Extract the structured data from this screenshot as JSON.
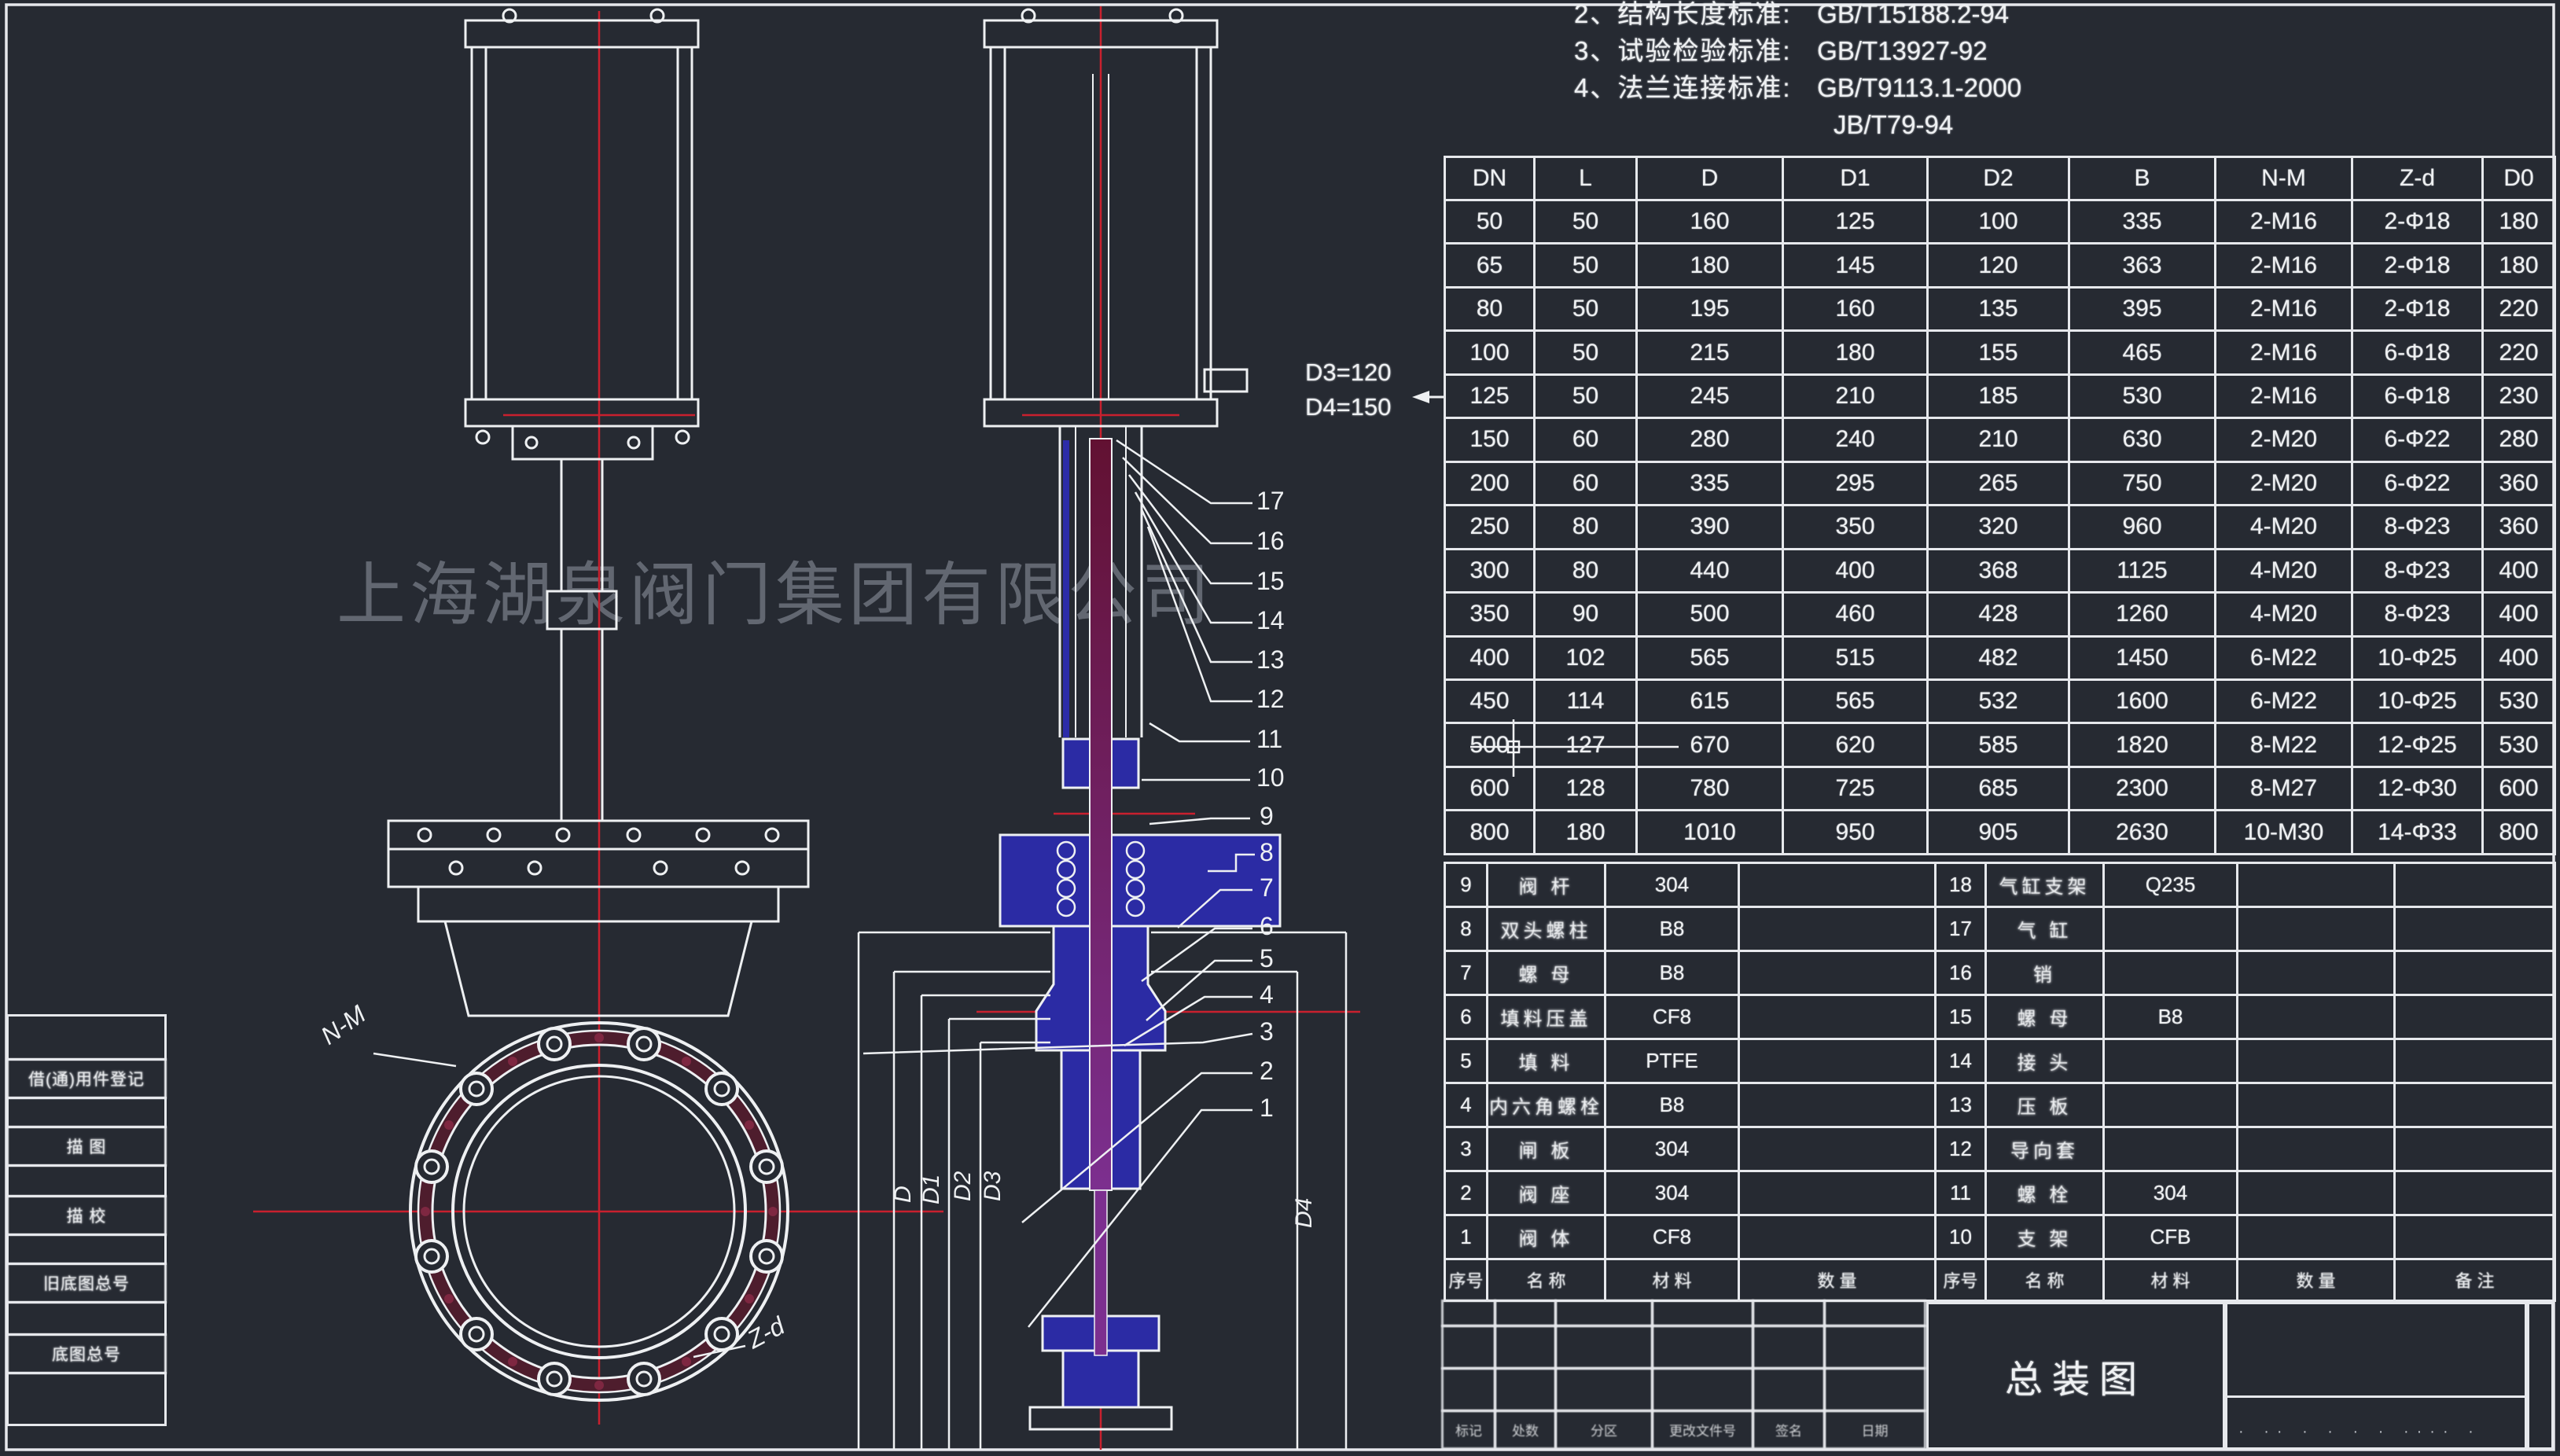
{
  "watermark": "上海湖泉阀门集团有限公司",
  "standards": {
    "lines": [
      {
        "label": "2、结构长度标准:",
        "value": "GB/T15188.2-94"
      },
      {
        "label": "3、试验检验标准:",
        "value": "GB/T13927-92"
      },
      {
        "label": "4、法兰连接标准:",
        "value": "GB/T9113.1-2000"
      },
      {
        "label": "",
        "value": "JB/T79-94"
      }
    ]
  },
  "annotation": {
    "d3": "D3=120",
    "d4": "D4=150"
  },
  "dim_table": {
    "headers": [
      "DN",
      "L",
      "D",
      "D1",
      "D2",
      "B",
      "N-M",
      "Z-d",
      "D0"
    ],
    "rows": [
      [
        "50",
        "50",
        "160",
        "125",
        "100",
        "335",
        "2-M16",
        "2-Φ18",
        "180"
      ],
      [
        "65",
        "50",
        "180",
        "145",
        "120",
        "363",
        "2-M16",
        "2-Φ18",
        "180"
      ],
      [
        "80",
        "50",
        "195",
        "160",
        "135",
        "395",
        "2-M16",
        "2-Φ18",
        "220"
      ],
      [
        "100",
        "50",
        "215",
        "180",
        "155",
        "465",
        "2-M16",
        "6-Φ18",
        "220"
      ],
      [
        "125",
        "50",
        "245",
        "210",
        "185",
        "530",
        "2-M16",
        "6-Φ18",
        "230"
      ],
      [
        "150",
        "60",
        "280",
        "240",
        "210",
        "630",
        "2-M20",
        "6-Φ22",
        "280"
      ],
      [
        "200",
        "60",
        "335",
        "295",
        "265",
        "750",
        "2-M20",
        "6-Φ22",
        "360"
      ],
      [
        "250",
        "80",
        "390",
        "350",
        "320",
        "960",
        "4-M20",
        "8-Φ23",
        "360"
      ],
      [
        "300",
        "80",
        "440",
        "400",
        "368",
        "1125",
        "4-M20",
        "8-Φ23",
        "400"
      ],
      [
        "350",
        "90",
        "500",
        "460",
        "428",
        "1260",
        "4-M20",
        "8-Φ23",
        "400"
      ],
      [
        "400",
        "102",
        "565",
        "515",
        "482",
        "1450",
        "6-M22",
        "10-Φ25",
        "400"
      ],
      [
        "450",
        "114",
        "615",
        "565",
        "532",
        "1600",
        "6-M22",
        "10-Φ25",
        "530"
      ],
      [
        "500",
        "127",
        "670",
        "620",
        "585",
        "1820",
        "8-M22",
        "12-Φ25",
        "530"
      ],
      [
        "600",
        "128",
        "780",
        "725",
        "685",
        "2300",
        "8-M27",
        "12-Φ30",
        "600"
      ],
      [
        "800",
        "180",
        "1010",
        "950",
        "905",
        "2630",
        "10-M30",
        "14-Φ33",
        "800"
      ]
    ]
  },
  "bom_left": {
    "rows": [
      [
        "9",
        "阀 杆",
        "304",
        ""
      ],
      [
        "8",
        "双头螺柱",
        "B8",
        ""
      ],
      [
        "7",
        "螺 母",
        "B8",
        ""
      ],
      [
        "6",
        "填料压盖",
        "CF8",
        ""
      ],
      [
        "5",
        "填 料",
        "PTFE",
        ""
      ],
      [
        "4",
        "内六角螺栓",
        "B8",
        ""
      ],
      [
        "3",
        "闸 板",
        "304",
        ""
      ],
      [
        "2",
        "阀 座",
        "304",
        ""
      ],
      [
        "1",
        "阀 体",
        "CF8",
        ""
      ]
    ]
  },
  "bom_right": {
    "rows": [
      [
        "18",
        "气缸支架",
        "Q235",
        "",
        ""
      ],
      [
        "17",
        "气 缸",
        "",
        "",
        ""
      ],
      [
        "16",
        "销",
        "",
        "",
        ""
      ],
      [
        "15",
        "螺 母",
        "B8",
        "",
        ""
      ],
      [
        "14",
        "接 头",
        "",
        "",
        ""
      ],
      [
        "13",
        "压 板",
        "",
        "",
        ""
      ],
      [
        "12",
        "导向套",
        "",
        "",
        ""
      ],
      [
        "11",
        "螺 栓",
        "304",
        "",
        ""
      ],
      [
        "10",
        "支 架",
        "CFB",
        "",
        ""
      ]
    ]
  },
  "bom_header": [
    "序号",
    "名 称",
    "材 料",
    "数 量",
    "备 注"
  ],
  "callouts": [
    "17",
    "16",
    "15",
    "14",
    "13",
    "12",
    "11",
    "10",
    "9",
    "8",
    "7",
    "6",
    "5",
    "4",
    "3",
    "2",
    "1"
  ],
  "dims": [
    "D",
    "D1",
    "D2",
    "D3",
    "D4"
  ],
  "front_labels": {
    "nm": "N-M",
    "zd": "Z-d"
  },
  "margin_labels": [
    "借(通)用件登记",
    "描 图",
    "描 校",
    "旧底图总号",
    "底图总号"
  ],
  "titleblock": {
    "title": "总装图",
    "small_labels": [
      "标记",
      "处数",
      "分区",
      "更改文件号",
      "签名",
      "日期"
    ],
    "dots": "· ·· · · · · ···· ·"
  },
  "colors": {
    "background": "#262a32",
    "line_white": "#eef0f2",
    "centerline_red": "#c9202e",
    "flange_maroon": "#4e1d2d",
    "yoke_blue": "#2b2ba4",
    "stem_purple": "#7c2f8f"
  }
}
